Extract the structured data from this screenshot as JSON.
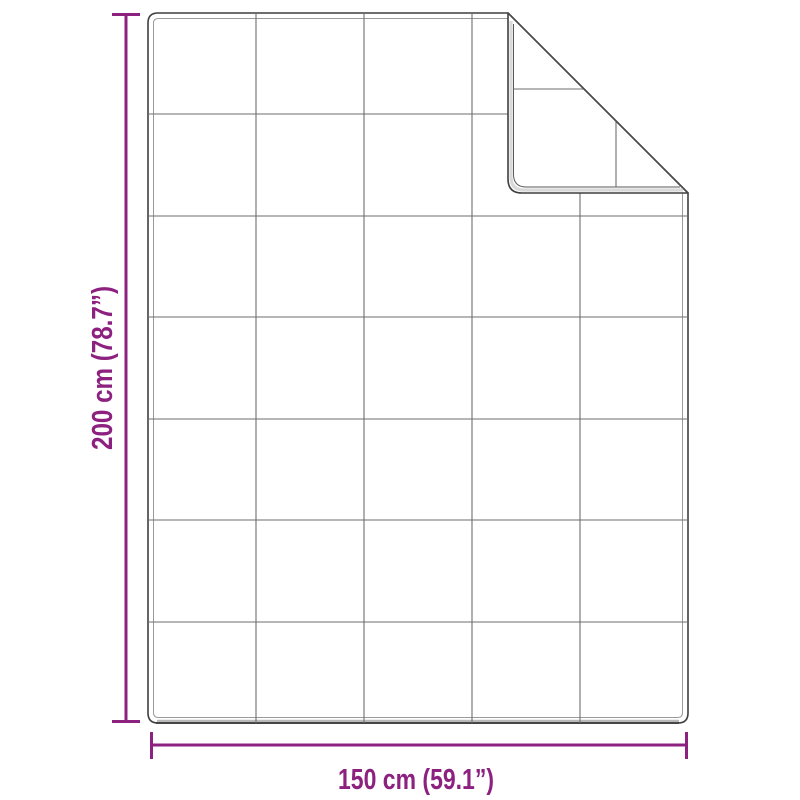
{
  "diagram": {
    "kind": "product-dimension-diagram",
    "subject": "quilted-blanket-with-folded-corner",
    "height_dimension": {
      "label": "200 cm (78.7”)"
    },
    "width_dimension": {
      "label": "150 cm (59.1”)"
    },
    "grid": {
      "columns": 5,
      "rows": 7
    },
    "fold": {
      "position": "top-right"
    },
    "colors": {
      "dimension_accent": "#8C2180",
      "outline": "#3f3f3f",
      "binding_line": "#9a9a9a",
      "grid_line": "#6e6e6e",
      "background": "#ffffff"
    }
  }
}
